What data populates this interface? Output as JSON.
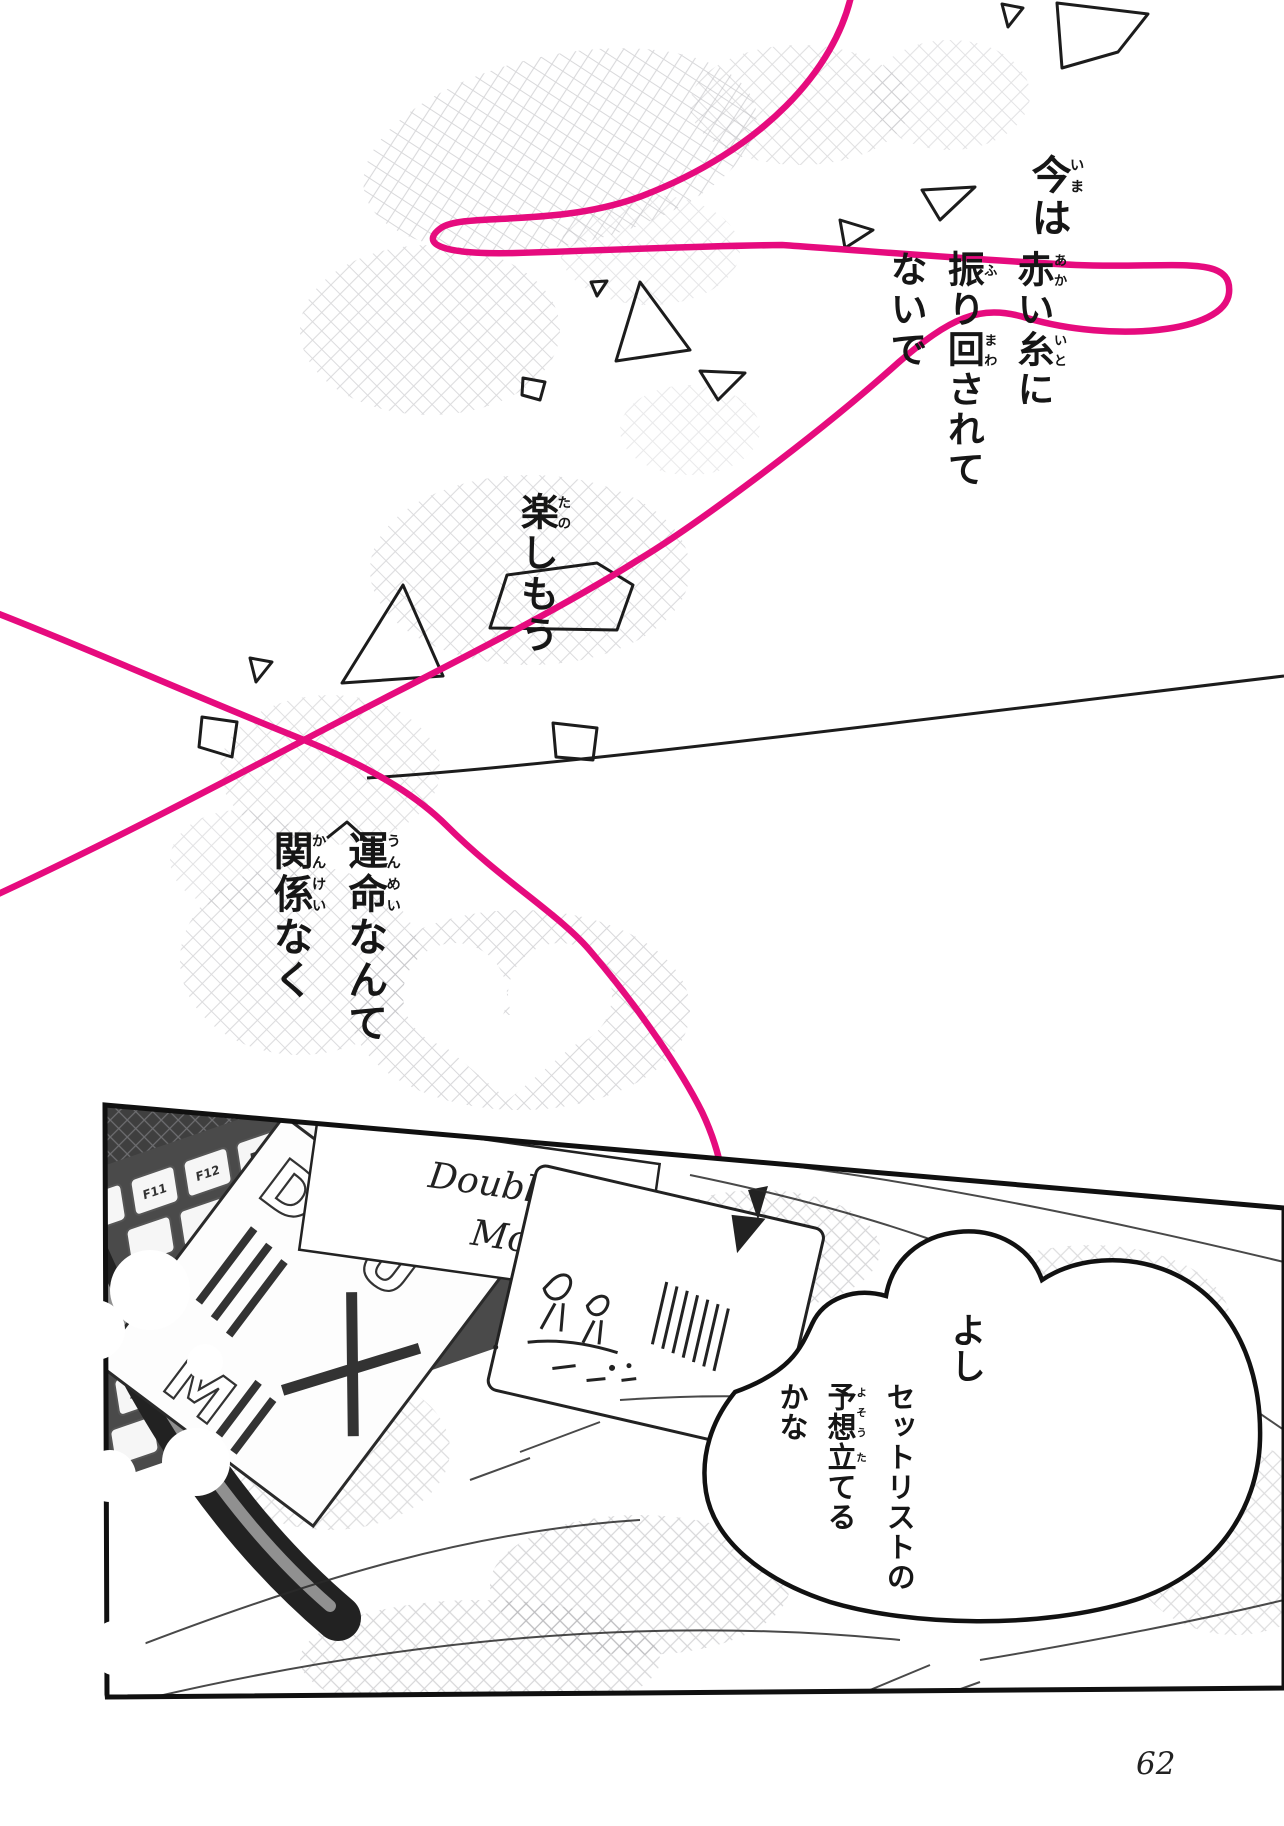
{
  "page": {
    "number": "62"
  },
  "colors": {
    "thread": "#e60b7e",
    "ink": "#1c1c1c",
    "paper": "#ffffff"
  },
  "captions": {
    "ima": [
      {
        "b": "今",
        "r": "いま"
      },
      {
        "b": "は",
        "r": ""
      }
    ],
    "akai_ito": [
      {
        "b": "赤",
        "r": "あか"
      },
      {
        "b": "い",
        "r": ""
      },
      {
        "b": "糸",
        "r": "いと"
      },
      {
        "b": "に",
        "r": ""
      }
    ],
    "furimawasarete": [
      {
        "b": "振",
        "r": "ふ"
      },
      {
        "b": "り",
        "r": ""
      },
      {
        "b": "回",
        "r": "まわ"
      },
      {
        "b": "されて",
        "r": ""
      }
    ],
    "naide": [
      {
        "b": "ないで",
        "r": ""
      }
    ],
    "tanoshimou": [
      {
        "b": "楽",
        "r": "たの"
      },
      {
        "b": "しもう",
        "r": ""
      }
    ],
    "unmei": [
      {
        "b": "運命",
        "r": "うんめい"
      },
      {
        "b": "なんて",
        "r": ""
      }
    ],
    "kankei": [
      {
        "b": "関係",
        "r": "かんけい"
      },
      {
        "b": "なく",
        "r": ""
      }
    ]
  },
  "bubble": {
    "yoshi": "よし",
    "line1": "セットリストの",
    "line2": [
      {
        "b": "予想",
        "r": "よそう"
      },
      {
        "b": "立",
        "r": "た"
      },
      {
        "b": "てる",
        "r": ""
      }
    ],
    "line3": "かな"
  },
  "panel": {
    "keyboard": {
      "keys": [
        "F11",
        "F12",
        "Del",
        "Enter",
        "Alt",
        "Ctrl"
      ]
    },
    "album_big": {
      "line1": "DOU",
      "line2": "M"
    },
    "album_script": {
      "line1": "Double",
      "line2": "Mountain"
    }
  }
}
